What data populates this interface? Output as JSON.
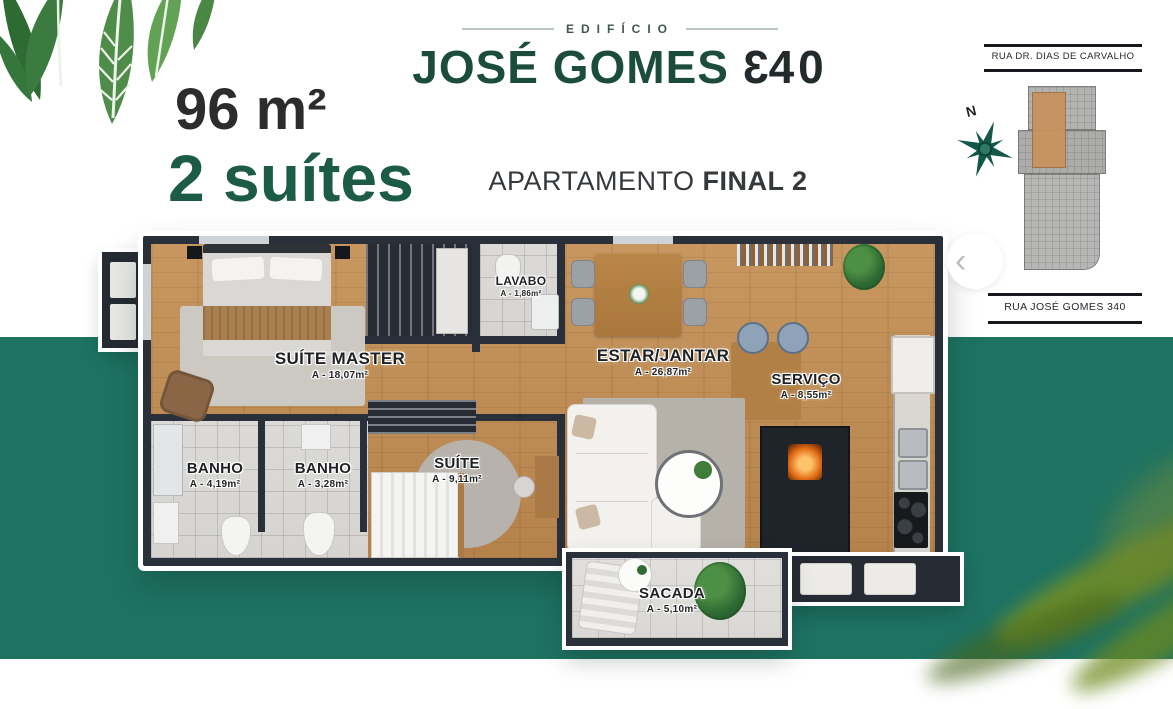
{
  "summary": {
    "area": "96 m²",
    "suites": "2 suítes"
  },
  "header": {
    "eyebrow": "EDIFÍCIO",
    "name": "JOSÉ GOMES",
    "number_first_digit": "3",
    "number_rest": "40",
    "subtitle_regular": "APARTAMENTO",
    "subtitle_bold": "FINAL 2"
  },
  "minimap": {
    "street_top": "RUA DR. DIAS DE CARVALHO",
    "street_bottom": "RUA JOSÉ GOMES 340",
    "compass_label": "N",
    "highlight_color": "#c7935e"
  },
  "carousel": {
    "prev_label": "‹"
  },
  "floorplan": {
    "rooms": [
      {
        "id": "suite-master",
        "name": "SUÍTE MASTER",
        "area": "A - 18,07m²"
      },
      {
        "id": "lavabo",
        "name": "LAVABO",
        "area": "A - 1,86m²"
      },
      {
        "id": "estar-jantar",
        "name": "ESTAR/JANTAR",
        "area": "A - 26,87m²"
      },
      {
        "id": "servico",
        "name": "SERVIÇO",
        "area": "A - 8,55m²"
      },
      {
        "id": "banho-1",
        "name": "BANHO",
        "area": "A - 4,19m²"
      },
      {
        "id": "banho-2",
        "name": "BANHO",
        "area": "A - 3,28m²"
      },
      {
        "id": "suite",
        "name": "SUÍTE",
        "area": "A - 9,11m²"
      },
      {
        "id": "sacada",
        "name": "SACADA",
        "area": "A - 5,10m²"
      }
    ]
  },
  "colors": {
    "teal_background": "#1E7262",
    "title_green": "#1B4C3D",
    "accent_green": "#1C5B45",
    "charcoal": "#2b2c2d",
    "wall": "#2A303A",
    "wood_floor": "#C3915A"
  }
}
